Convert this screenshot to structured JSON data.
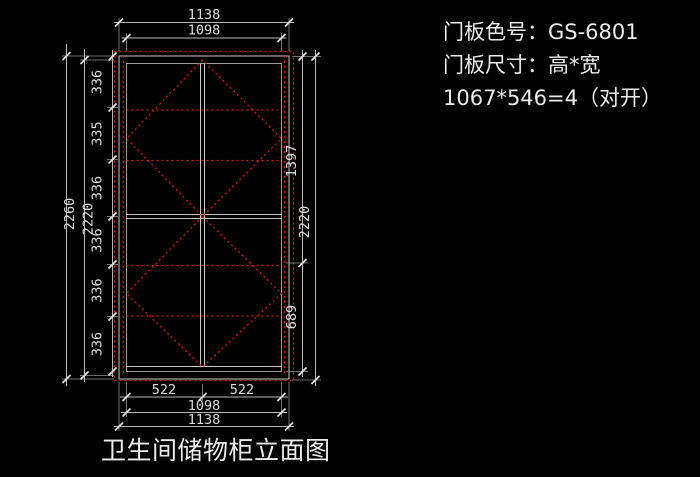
{
  "drawing": {
    "caption": "卫生间储物柜立面图",
    "notes": {
      "line1": "门板色号：GS-6801",
      "line2": "门板尺寸：高*宽",
      "line3": "1067*546=4（对开）"
    },
    "dimensions": {
      "top_outer": "1138",
      "top_inner": "1098",
      "left_outer": "2260",
      "left_inner": "2220",
      "left_chain": [
        "336",
        "335",
        "336",
        "336",
        "336",
        "336"
      ],
      "right_upper": "1397",
      "right_lower": "689",
      "right_overall": "2220",
      "bottom_door_left": "522",
      "bottom_door_right": "522",
      "bottom_inner": "1098",
      "bottom_outer": "1138"
    },
    "colors": {
      "background": "#000000",
      "outline": "#c8c8c8",
      "hidden_line_red": "#cf1b1b",
      "text": "#ececec"
    }
  }
}
